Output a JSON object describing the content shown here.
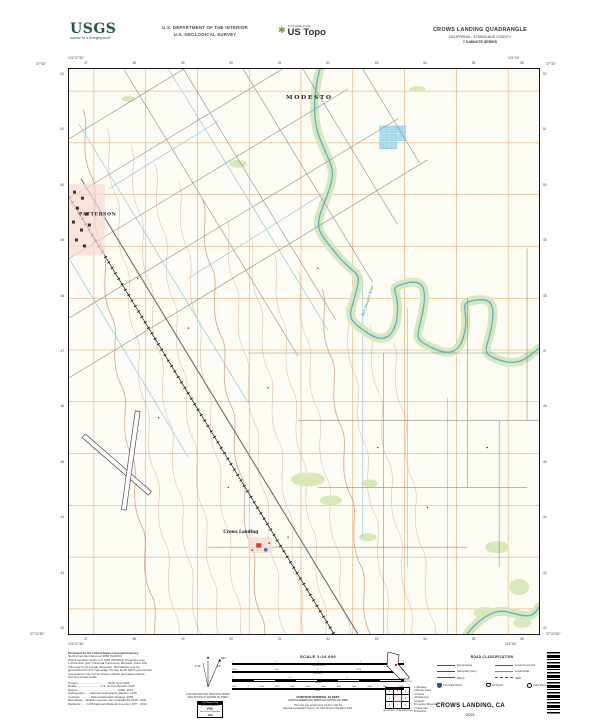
{
  "header": {
    "usgs_logo": {
      "acronym": "USGS",
      "tagline": "science for a changing world"
    },
    "dept_line1": "U.S. DEPARTMENT OF THE INTERIOR",
    "dept_line2": "U.S. GEOLOGICAL SURVEY",
    "ustopo": {
      "brand_top": "The National Map",
      "brand_main": "US Topo"
    },
    "quad": {
      "title": "CROWS LANDING QUADRANGLE",
      "subtitle": "CALIFORNIA - STANISLAUS COUNTY",
      "series": "7.5-MINUTE SERIES"
    }
  },
  "map": {
    "place_labels": {
      "city": "MODESTO",
      "town_left": "PATTERSON",
      "town_center": "Crows Landing",
      "river": "San Joaquin River"
    },
    "corners": {
      "tl_lat": "37°30'",
      "tl_lon": "121°07'30\"",
      "tr_lat": "37°30'",
      "tr_lon": "121°00'",
      "bl_lat": "37°22'30\"",
      "bl_lon": "121°07'30\"",
      "br_lat": "37°22'30\"",
      "br_lon": "121°00'"
    },
    "grid_top": [
      "47",
      "48",
      "49",
      "50",
      "51",
      "52",
      "53",
      "54",
      "55",
      "56"
    ],
    "grid_bottom": [
      "47",
      "48",
      "49",
      "50",
      "51",
      "52",
      "53",
      "54",
      "55",
      "56"
    ],
    "grid_left": [
      "52",
      "51",
      "50",
      "49",
      "48",
      "47",
      "46",
      "45",
      "44",
      "43",
      "42"
    ],
    "grid_right": [
      "52",
      "51",
      "50",
      "49",
      "48",
      "47",
      "46",
      "45",
      "44",
      "43",
      "42"
    ],
    "colors": {
      "grid": "#e09143",
      "water": "#58aed6",
      "vegetation": "#d7e9b8",
      "contour": "#cfa078",
      "urban": "#e23b2e"
    }
  },
  "footer": {
    "produced": [
      "Produced by the United States Geological Survey",
      "North American Datum of 1983 (NAD83)",
      "World Geodetic System of 1984 (WGS84). Projection and",
      "1 000-meter grid: Universal Transverse Mercator, Zone 10S",
      "This map is not a legal document. Boundaries may be",
      "generalized for this map scale. Private lands within government",
      "reservations may not be shown. Obtain permission before",
      "entering private lands."
    ],
    "credits": [
      "Imagery.....................................NAIP, June 2020",
      "Roads..............................U.S. Census Bureau, 2016",
      "Names...................................................GNIS, 2021",
      "Hydrography.......National Hydrography Dataset, 2015",
      "Contours..............National Elevation Dataset, 2000",
      "Boundaries....Multiple sources; see metadata file 2018 - 2021",
      "Wetlands.........FWS National Wetlands Inventory 1977 - 2014"
    ],
    "declination": {
      "star": "★",
      "gn_deg": "1°12'",
      "mn": "MN",
      "mn_deg": "13°",
      "caption1": "UTM GRID AND 2021 MAGNETIC NORTH",
      "caption2": "DECLINATION AT CENTER OF SHEET"
    },
    "usng": {
      "title": "U.S. National Grid",
      "square_label": "100,000-m Square ID",
      "square": "FG",
      "zone_label": "Grid Zone Designation",
      "zone": "10S"
    },
    "scale": {
      "title": "SCALE 1:24 000",
      "rows": [
        {
          "unit": "KILOMETERS",
          "ticks": [
            "1",
            ".5",
            "0",
            "1",
            "2"
          ]
        },
        {
          "unit": "METERS",
          "ticks": [
            "1000",
            "500",
            "0",
            "1000",
            "2000"
          ]
        },
        {
          "unit": "MILES",
          "ticks": [
            "1",
            "0.5",
            "0",
            "1"
          ]
        },
        {
          "unit": "FEET",
          "ticks": [
            "1000",
            "0",
            "1000",
            "2000",
            "3000",
            "4000",
            "5000",
            "6000",
            "7000",
            "8000",
            "9000",
            "10000"
          ]
        }
      ],
      "contour_note1": "CONTOUR INTERVAL 10 FEET",
      "contour_note2": "NORTH AMERICAN VERTICAL DATUM OF 1988",
      "std_note1": "This map was produced to conform with the",
      "std_note2": "National Geospatial Program US Topo Product Standard, 2021."
    },
    "location": {
      "caption": "QUADRANGLE LOCATION"
    },
    "adjoining": {
      "caption": "ADJOINING QUADRANGLES",
      "grid_numbers": [
        "1",
        "2",
        "3",
        "4",
        "5",
        "6",
        "7",
        "8"
      ],
      "list": [
        "1 Westley",
        "2 Brush Lake",
        "3 Ceres",
        "4 Patterson",
        "5 Hatch",
        "6 Copper Mountain",
        "7 Newman",
        "8 Gustine"
      ]
    },
    "road_class": {
      "title": "ROAD CLASSIFICATION",
      "rows": [
        {
          "label": "Expressway"
        },
        {
          "label": "Secondary Hwy"
        },
        {
          "label": "Ramp"
        },
        {
          "label": "Local Connector"
        },
        {
          "label": "Local Road"
        },
        {
          "label": "4WD"
        }
      ],
      "shields": [
        "Interstate Route",
        "US Route",
        "State Route"
      ]
    },
    "sheet_title": "CROWS LANDING, CA",
    "year": "2021"
  }
}
